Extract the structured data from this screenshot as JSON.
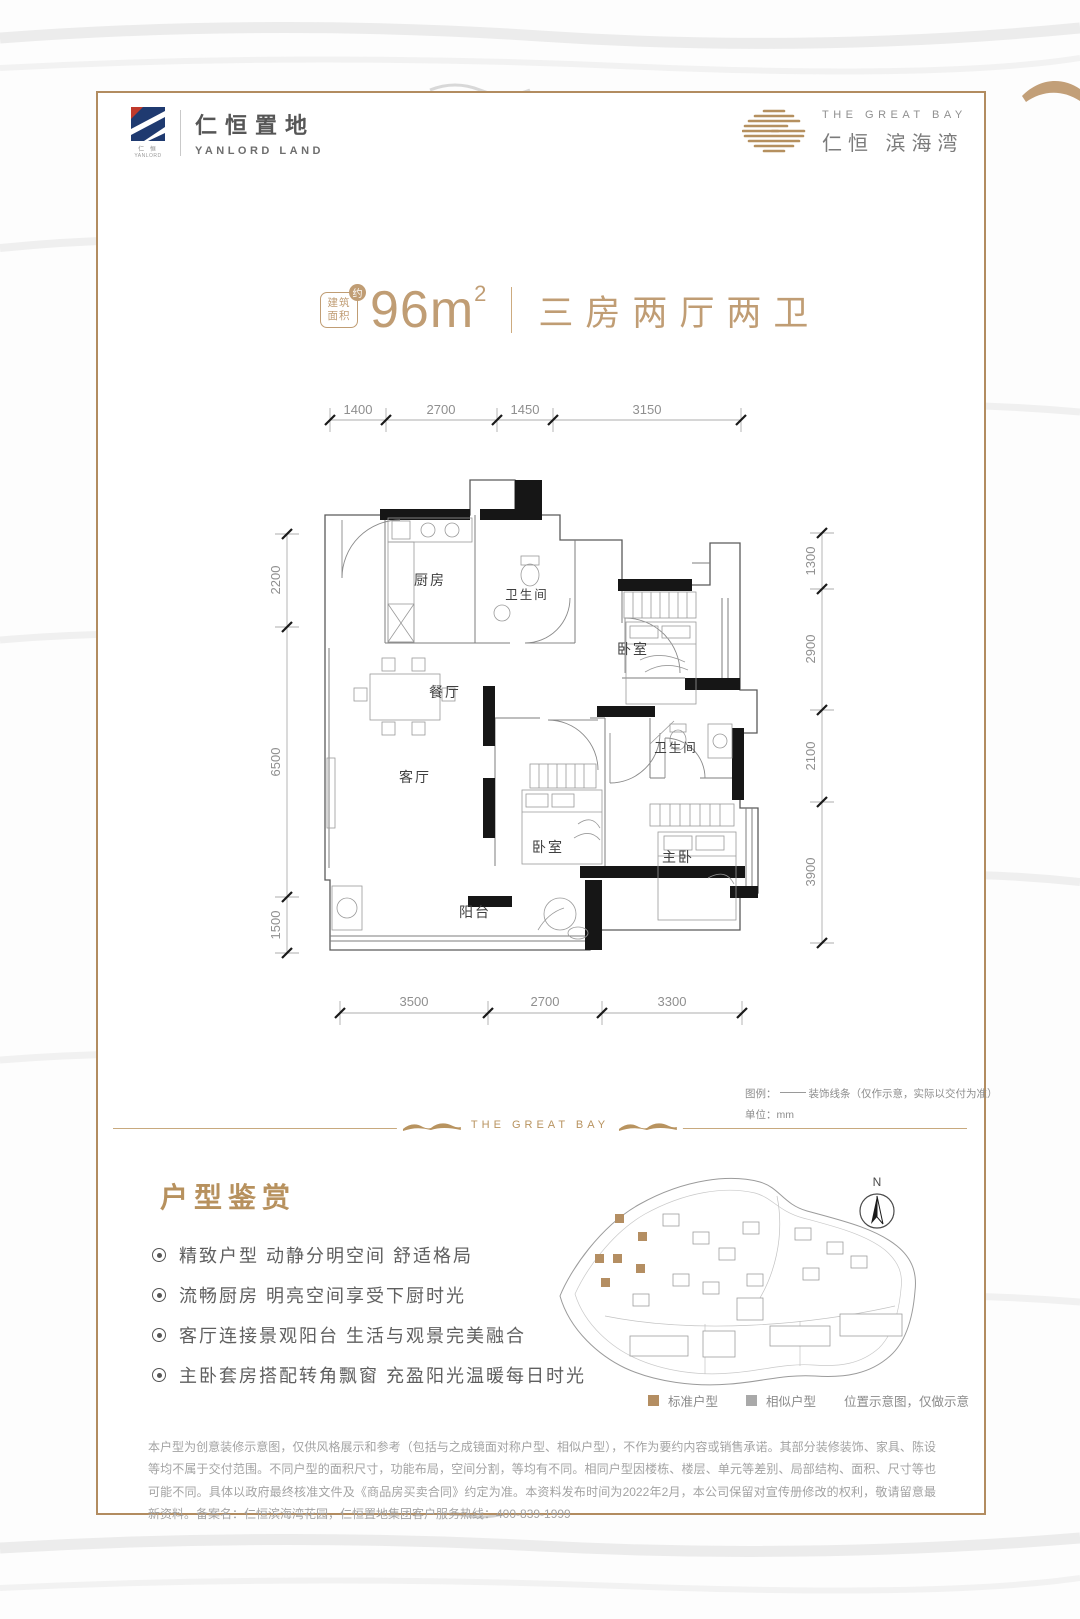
{
  "header": {
    "yanlord_cn": "仁恒置地",
    "yanlord_en": "YANLORD LAND",
    "yanlord_mark_cn": "仁 恒",
    "yanlord_mark_en": "YANLORD",
    "greatbay_en": "THE GREAT BAY",
    "greatbay_cn": "仁恒 滨海湾"
  },
  "title": {
    "area_badge_line1": "建筑",
    "area_badge_line2": "面积",
    "approx": "约",
    "area_value": "96m",
    "area_sup": "2",
    "layout": "三房两厅两卫"
  },
  "floorplan": {
    "dims_top": [
      "1400",
      "2700",
      "1450",
      "3150"
    ],
    "dims_left": [
      "2200",
      "6500",
      "1500"
    ],
    "dims_right": [
      "1300",
      "2900",
      "2100",
      "3900"
    ],
    "dims_bottom": [
      "3500",
      "2700",
      "3300"
    ],
    "rooms": {
      "kitchen": "厨房",
      "bath1": "卫生间",
      "bedroom1": "卧室",
      "dining": "餐厅",
      "living": "客厅",
      "bath2": "卫生间",
      "bedroom2": "卧室",
      "master": "主卧",
      "balcony": "阳台"
    },
    "legend_label": "图例：",
    "legend_text": "装饰线条（仅作示意，实际以交付为准）",
    "unit_text": "单位：mm"
  },
  "divider": {
    "text": "THE GREAT BAY"
  },
  "appreciation": {
    "heading": "户型鉴赏",
    "bullets": [
      "精致户型 动静分明空间 舒适格局",
      "流畅厨房 明亮空间享受下厨时光",
      "客厅连接景观阳台 生活与观景完美融合",
      "主卧套房搭配转角飘窗 充盈阳光温暖每日时光"
    ]
  },
  "sitemap": {
    "north": "N",
    "legend_standard": "标准户型",
    "legend_similar": "相似户型",
    "legend_note": "位置示意图，仅做示意"
  },
  "disclaimer": "本户型为创意装修示意图，仅供风格展示和参考（包括与之成镜面对称户型、相似户型），不作为要约内容或销售承诺。其部分装修装饰、家具、陈设等均不属于交付范围。不同户型的面积尺寸，功能布局，空间分割，等均有不同。相同户型因楼栋、楼层、单元等差别、局部结构、面积、尺寸等也可能不同。具体以政府最终核准文件及《商品房买卖合同》约定为准。本资料发布时间为2022年2月，本公司保留对宣传册修改的权利，敬请留意最新资料。备案名：仁恒滨海湾花园，仁恒置地集团客户服务热线：400-839-1999",
  "colors": {
    "gold": "#b5905f",
    "frame": "#b28c60",
    "title_gold": "#c09d74",
    "logo_navy": "#1f3a70",
    "logo_red": "#c0392b",
    "similar_gray": "#a9a9a9",
    "wall_black": "#161616"
  }
}
